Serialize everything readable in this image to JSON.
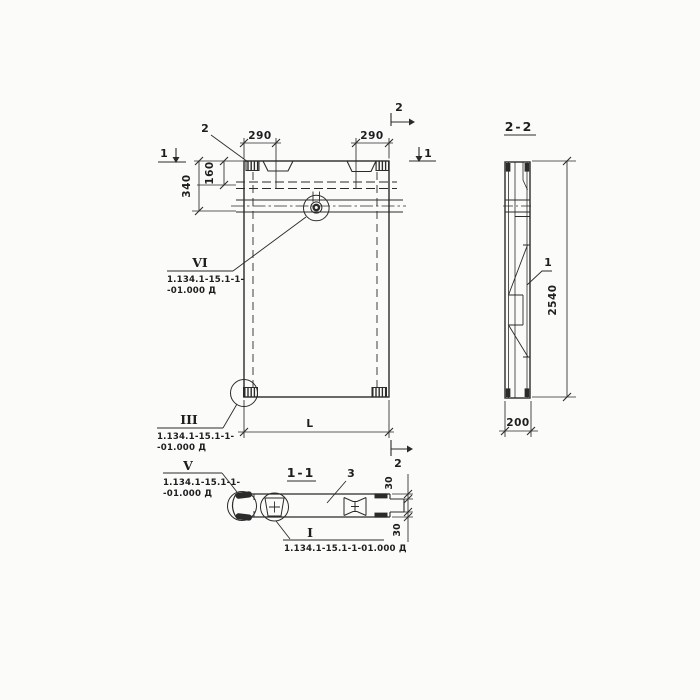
{
  "plan": {
    "callout_2": "2",
    "marker_1_left": "1",
    "marker_1_right": "1",
    "marker_2_top": "2",
    "marker_2_bottom": "2",
    "dim_290_left": "290",
    "dim_290_right": "290",
    "dim_160": "160",
    "dim_340": "340",
    "dim_length": "L",
    "detail_vi": {
      "num": "VI",
      "ref1": "1.134.1-15.1-1-",
      "ref2": "-01.000 Д"
    },
    "detail_iii": {
      "num": "III",
      "ref1": "1.134.1-15.1-1-",
      "ref2": "-01.000 Д"
    }
  },
  "section22": {
    "label": "2-2",
    "callout_1": "1",
    "dim_height": "2540",
    "dim_width": "200"
  },
  "section11": {
    "label": "1-1",
    "callout_3": "3",
    "dim_30_top": "30",
    "dim_30_bottom": "30",
    "detail_v": {
      "num": "V",
      "ref1": "1.134.1-15.1-1-",
      "ref2": "-01.000 Д"
    },
    "detail_i": {
      "num": "I",
      "ref": "1.134.1-15.1-1-01.000 Д"
    }
  },
  "colors": {
    "line": "#2b2b2b",
    "paper": "#fbfbf9"
  }
}
